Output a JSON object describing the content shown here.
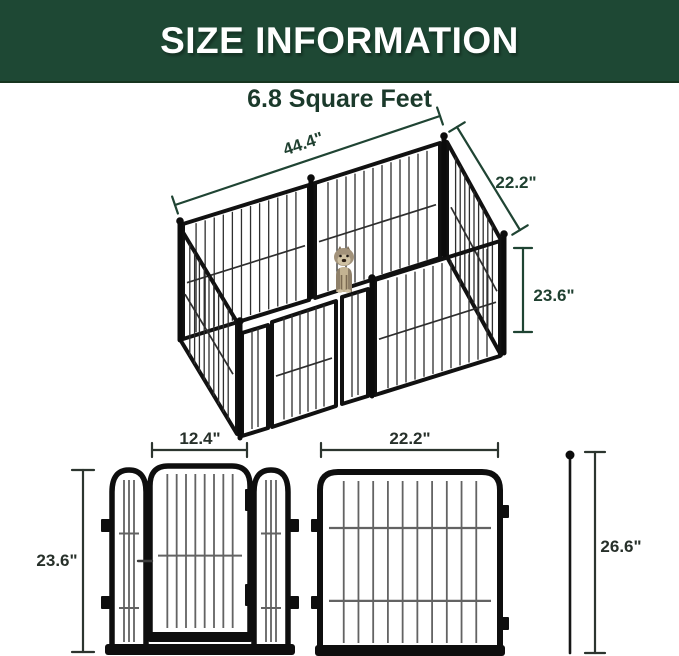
{
  "header": {
    "title": "SIZE INFORMATION"
  },
  "area": {
    "label": "6.8 Square Feet"
  },
  "isometric": {
    "length_label": "44.4\"",
    "depth_label": "22.2\"",
    "height_label": "23.6\""
  },
  "door_panel": {
    "width_label": "12.4\"",
    "height_label": "23.6\""
  },
  "wire_panel": {
    "width_label": "22.2\""
  },
  "stake": {
    "height_label": "26.6\""
  },
  "colors": {
    "header_bg": "#1e4834",
    "header_text": "#ffffff",
    "subtitle_text": "#1b3a2b",
    "dimension_green": "#1f4030",
    "dimension_dark": "#27302a",
    "metal_black": "#0e0e0e",
    "wire_gray": "#636363"
  }
}
